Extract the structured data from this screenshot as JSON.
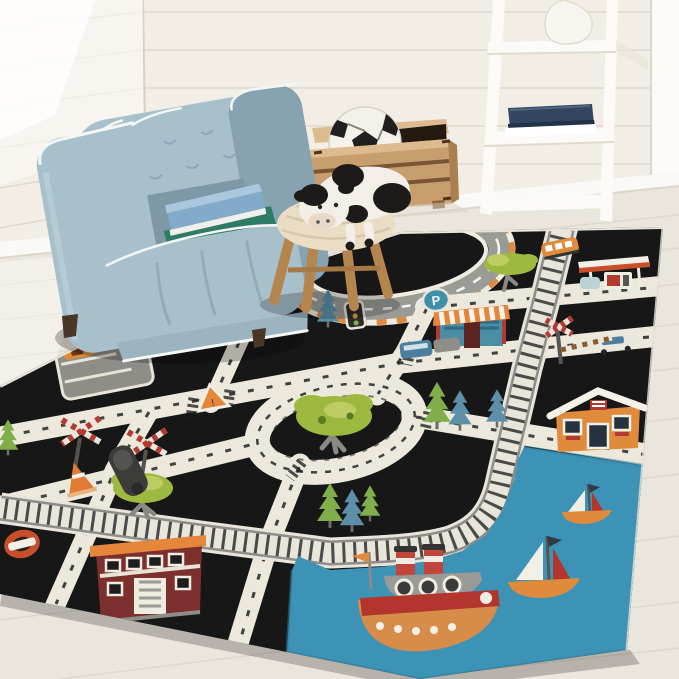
{
  "scene": {
    "label": "Kids playroom corner with road-map area rug",
    "rug_style": "black city road play rug with train tracks and harbor"
  },
  "rug": {
    "parking_sign_letter": "P"
  },
  "objects": {
    "armchair": {
      "label": "light blue tufted kids armchair with two books on seat"
    },
    "books_on_chair": {
      "label": "blue book stacked on green book"
    },
    "crate": {
      "label": "wooden storage crate"
    },
    "soccer_ball": {
      "label": "plush soccer ball in crate"
    },
    "ladder_shelf": {
      "label": "white ladder shelf with vase and navy books"
    },
    "stool": {
      "label": "wooden stool with knitted cream top"
    },
    "cow": {
      "label": "black and white plush cow lying on stool"
    },
    "rug": {
      "label": "black road play rug"
    },
    "racetrack": {
      "label": "oval racetrack with orange curbs"
    },
    "roundabout": {
      "label": "roundabout with large green tree"
    },
    "train_track": {
      "label": "train track curving around harbor"
    },
    "water": {
      "label": "blue harbor water"
    },
    "ferry": {
      "label": "orange ferry boat with two funnels"
    },
    "sailboats": {
      "label": "two sailboats with white and red sails"
    },
    "gas_station": {
      "label": "gas station canopy with pumps"
    },
    "shop": {
      "label": "shop with striped awning"
    },
    "house": {
      "label": "orange house with white roof"
    },
    "fire_station": {
      "label": "dark red station building with orange roof"
    },
    "parking_lot": {
      "label": "gray parking lot with orange car"
    },
    "signs": {
      "label": "crossing signs, triangle warning, no-entry, cone, traffic light, parking sign"
    }
  },
  "colors": {
    "wall": "#f2eee6",
    "wall_line": "#ddd7cc",
    "wall_bright": "#fdfcf9",
    "floor": "#ebe6dd",
    "floor_line": "#d8d2c6",
    "baseboard": "#faf9f5",
    "rug_black": "#171717",
    "rug_edge": "#e9e5da",
    "road": "#ece8db",
    "road_dash": "#242424",
    "track_base": "#e9e5da",
    "track_rail": "#8d8d8a",
    "track_tie": "#4a4a48",
    "water": "#3d93b5",
    "chair": "#a8c0cc",
    "chair_dark": "#87a3b1",
    "chair_light": "#bfd4dc",
    "piping": "#f5f7f6",
    "book_blue": "#82aac9",
    "book_teal": "#2e7c66",
    "crate_wood": "#c99e6e",
    "crate_dark": "#6b4a2c",
    "crate_light": "#ddbb8e",
    "shelf_white": "#fbfaf6",
    "navy": "#32465f",
    "vase": "#f7f5f0",
    "stool_wood": "#b5854e",
    "knit": "#eaddc4",
    "cow_white": "#f3efe8",
    "cow_black": "#1d1b1a",
    "cow_muzzle": "#e8d9c8",
    "tree_green": "#9db93f",
    "tree_light": "#c6d26a",
    "pine_green": "#7fae4a",
    "pine_blue": "#5d90a8",
    "trunk": "#8a8a82",
    "accent_orange": "#e08a3c",
    "awning_orange": "#e5863a",
    "red": "#b23a30",
    "maroon": "#7c2f2c",
    "lot_gray": "#8f8d88",
    "race_gray": "#9b9b96",
    "sign_red": "#c94f2c",
    "cone_orange": "#e07b35",
    "gray_mid": "#9a9a96"
  }
}
